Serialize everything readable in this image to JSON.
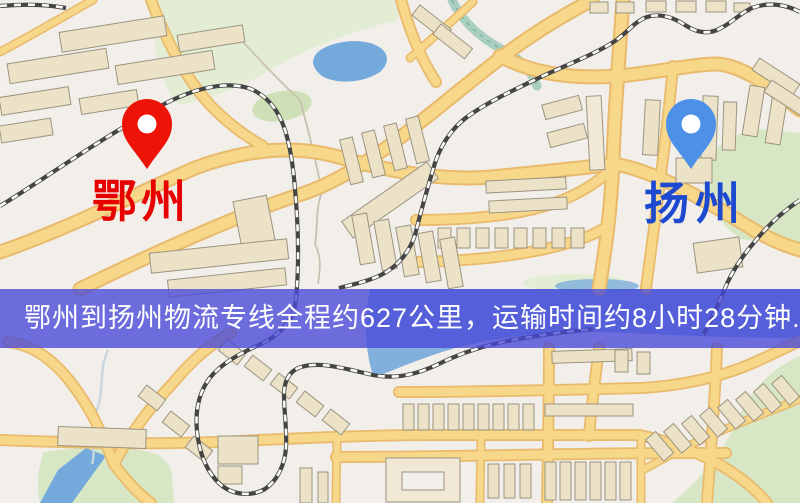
{
  "banner": {
    "text": "鄂州到扬州物流专线全程约627公里，运输时间约8小时28分钟.",
    "bg": "rgba(72,72,215,0.78)",
    "text_color": "#ffffff"
  },
  "markers": {
    "origin": {
      "label": "鄂州",
      "pin_color": "#ed1407",
      "label_color": "#e60000"
    },
    "destination": {
      "label": "扬州",
      "pin_color": "#4d90e8",
      "label_color": "#1c49cf"
    }
  },
  "palette": {
    "land": "#f2eeea",
    "road_fill": "#f7d78a",
    "road_casing": "#e9ba6b",
    "park": "#e3edd3",
    "park2": "#d7e7c5",
    "water": "#74a9db",
    "building": "#ece2c8",
    "rail_dark": "#454545",
    "banner_bg": "rgba(72,72,215,0.78)",
    "banner_text": "#ffffff",
    "origin_label": "#e60000",
    "dest_label": "#1c49cf",
    "origin_pin": "#ed1407",
    "dest_pin": "#4d90e8"
  }
}
